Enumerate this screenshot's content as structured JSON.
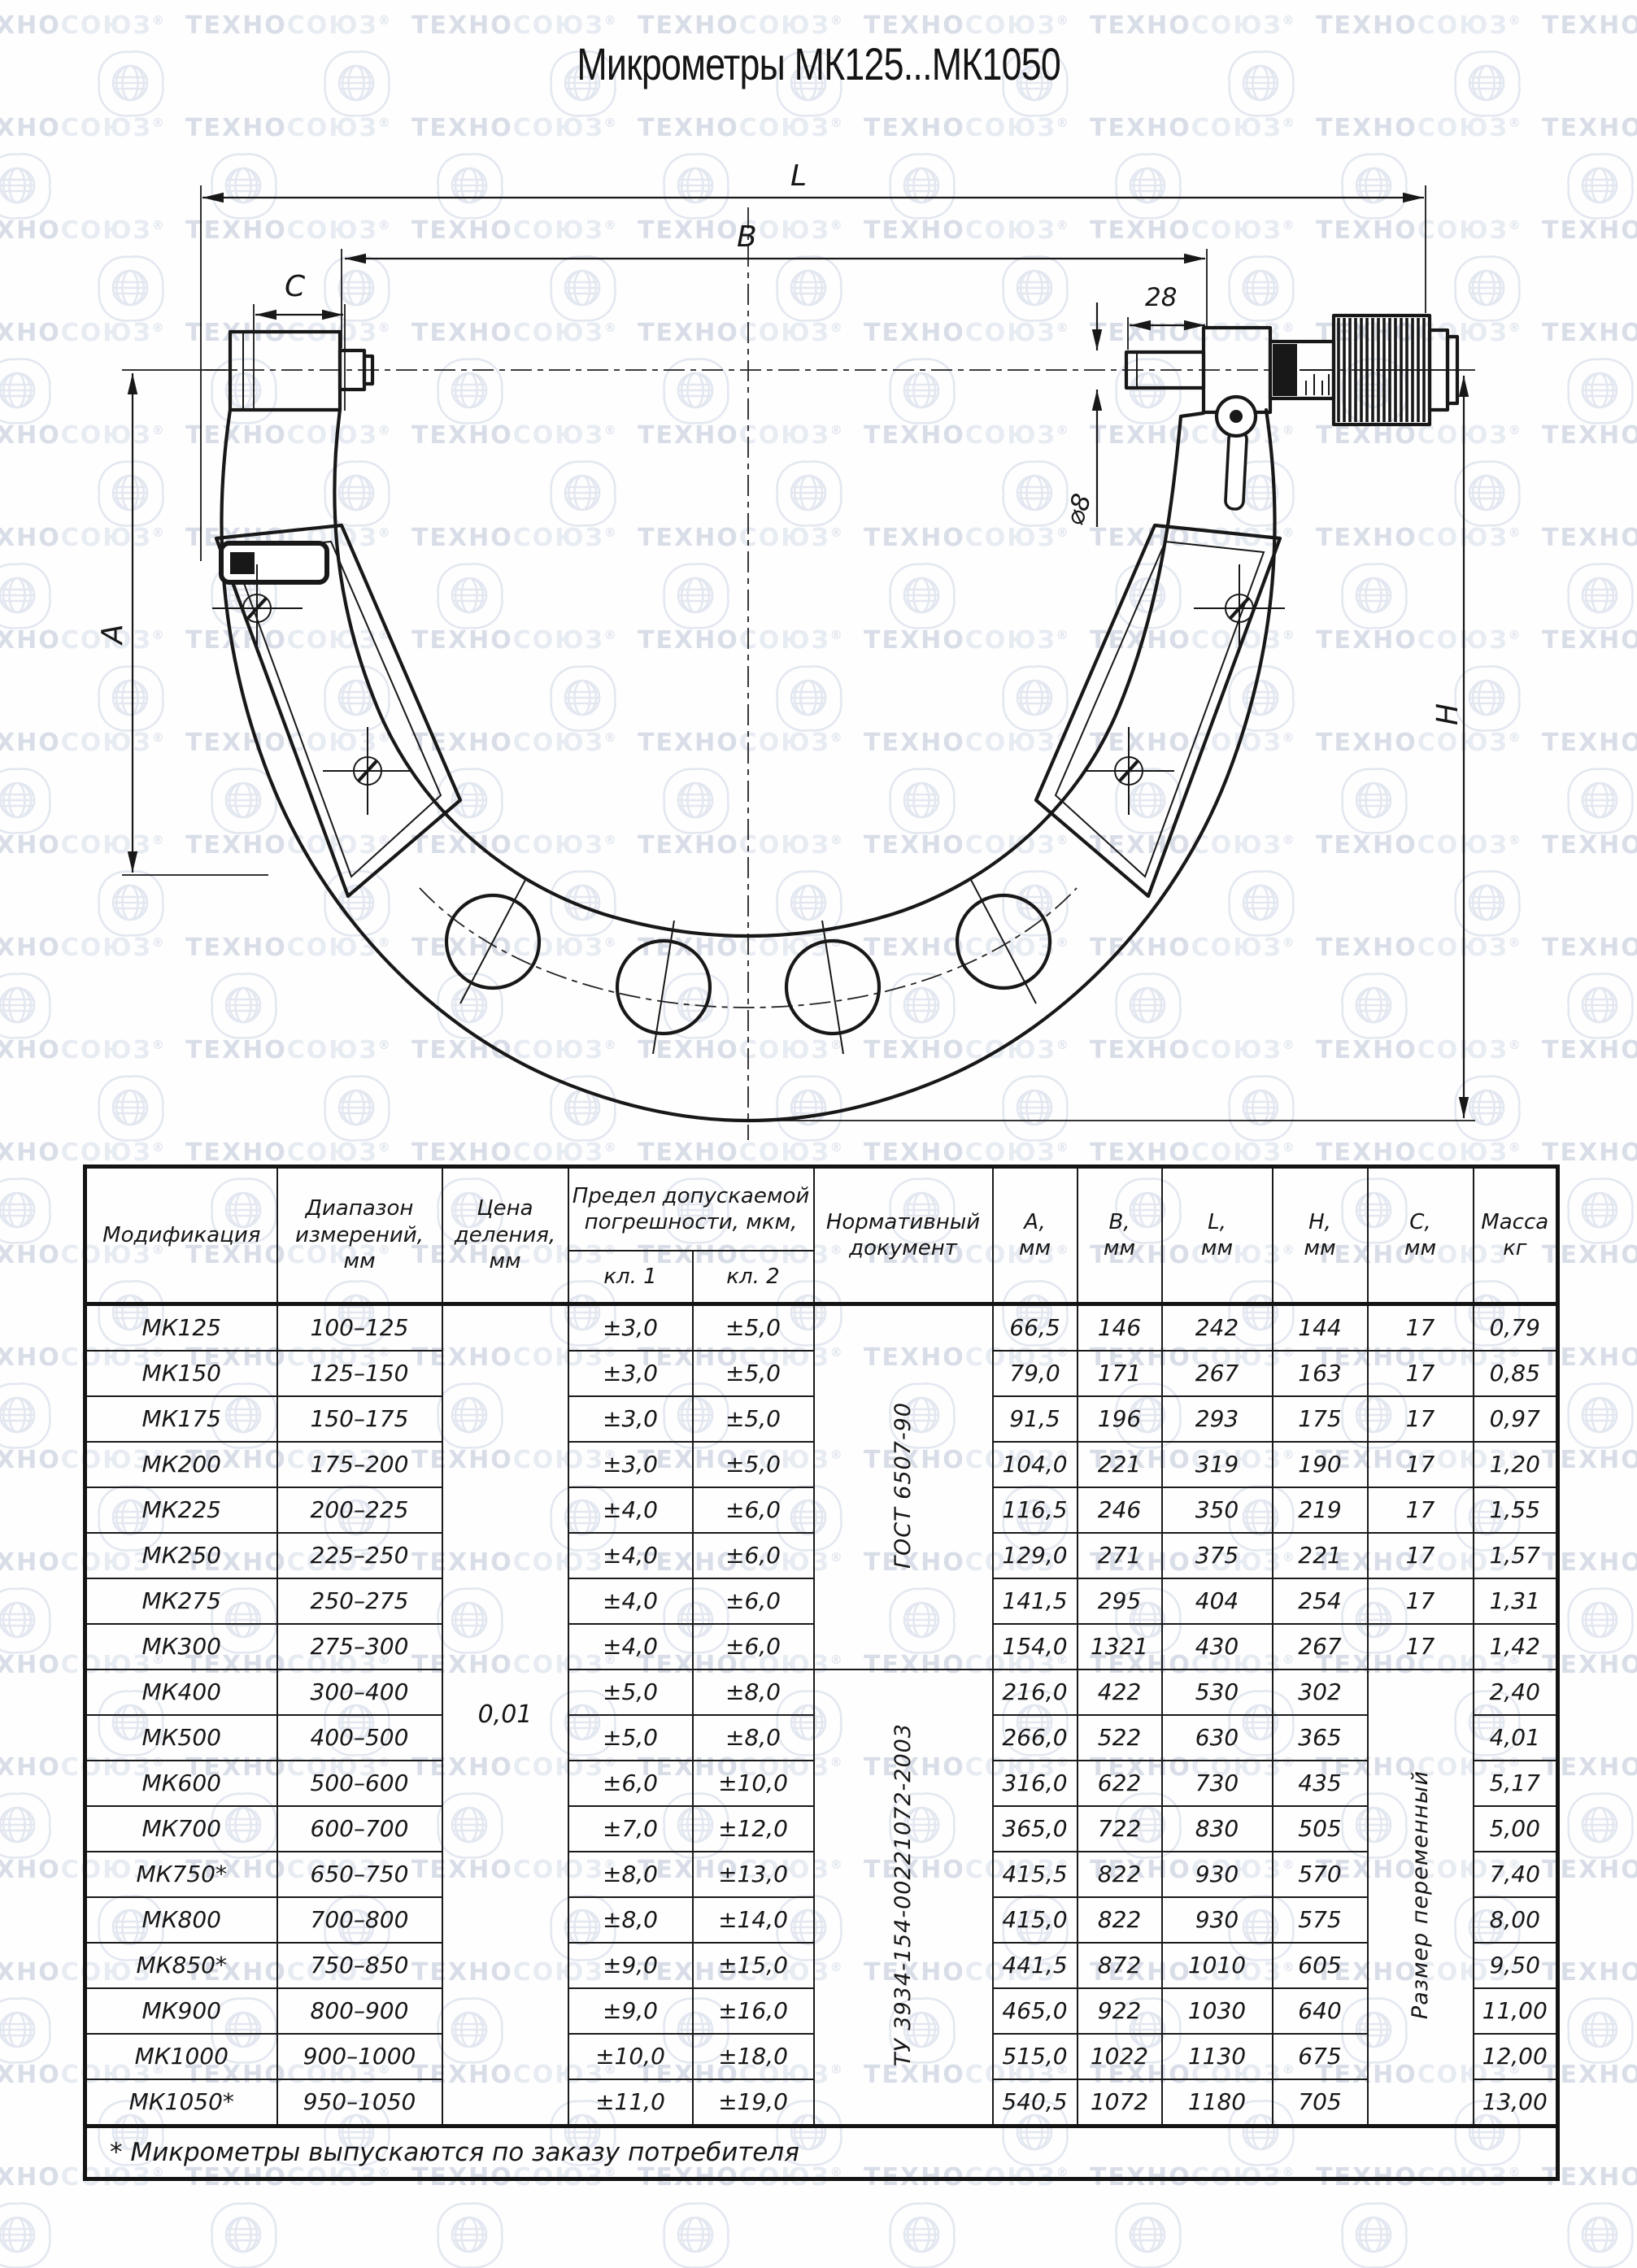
{
  "watermark": {
    "text1": "ТЕХНО",
    "text2": "СОЮЗ",
    "reg": "®"
  },
  "title": "Микрометры МК125...МК1050",
  "drawing": {
    "labels": {
      "L": "L",
      "B": "B",
      "C": "C",
      "d28": "28",
      "dia8": "⌀8",
      "A": "A",
      "H": "H"
    }
  },
  "table": {
    "headers": {
      "modification": "Модификация",
      "range": "Диапазон\nизмерений,\nмм",
      "division": "Цена\nделения,\nмм",
      "error": "Предел допускаемой\nпогрешности, мкм,",
      "class1": "кл. 1",
      "class2": "кл. 2",
      "document": "Нормативный\nдокумент",
      "colA": "A,\nмм",
      "colB": "B,\nмм",
      "colL": "L,\nмм",
      "colH": "H,\nмм",
      "colC": "C,\nмм",
      "mass": "Масса\nкг"
    },
    "division_value": "0,01",
    "doc_groups": [
      {
        "label": "ГОСТ 6507-90",
        "rows": 8
      },
      {
        "label": "ТУ 3934-154-00221072-2003",
        "rows": 10
      }
    ],
    "c_fixed_rows": 8,
    "c_variable_label": "Размер переменный",
    "rows": [
      {
        "model": "МК125",
        "range": "100–125",
        "cl1": "±3,0",
        "cl2": "±5,0",
        "a": "66,5",
        "b": "146",
        "l": "242",
        "h": "144",
        "c": "17",
        "mass": "0,79"
      },
      {
        "model": "МК150",
        "range": "125–150",
        "cl1": "±3,0",
        "cl2": "±5,0",
        "a": "79,0",
        "b": "171",
        "l": "267",
        "h": "163",
        "c": "17",
        "mass": "0,85"
      },
      {
        "model": "МК175",
        "range": "150–175",
        "cl1": "±3,0",
        "cl2": "±5,0",
        "a": "91,5",
        "b": "196",
        "l": "293",
        "h": "175",
        "c": "17",
        "mass": "0,97"
      },
      {
        "model": "МК200",
        "range": "175–200",
        "cl1": "±3,0",
        "cl2": "±5,0",
        "a": "104,0",
        "b": "221",
        "l": "319",
        "h": "190",
        "c": "17",
        "mass": "1,20"
      },
      {
        "model": "МК225",
        "range": "200–225",
        "cl1": "±4,0",
        "cl2": "±6,0",
        "a": "116,5",
        "b": "246",
        "l": "350",
        "h": "219",
        "c": "17",
        "mass": "1,55"
      },
      {
        "model": "МК250",
        "range": "225–250",
        "cl1": "±4,0",
        "cl2": "±6,0",
        "a": "129,0",
        "b": "271",
        "l": "375",
        "h": "221",
        "c": "17",
        "mass": "1,57"
      },
      {
        "model": "МК275",
        "range": "250–275",
        "cl1": "±4,0",
        "cl2": "±6,0",
        "a": "141,5",
        "b": "295",
        "l": "404",
        "h": "254",
        "c": "17",
        "mass": "1,31"
      },
      {
        "model": "МК300",
        "range": "275–300",
        "cl1": "±4,0",
        "cl2": "±6,0",
        "a": "154,0",
        "b": "1321",
        "l": "430",
        "h": "267",
        "c": "17",
        "mass": "1,42"
      },
      {
        "model": "МК400",
        "range": "300–400",
        "cl1": "±5,0",
        "cl2": "±8,0",
        "a": "216,0",
        "b": "422",
        "l": "530",
        "h": "302",
        "c": "",
        "mass": "2,40"
      },
      {
        "model": "МК500",
        "range": "400–500",
        "cl1": "±5,0",
        "cl2": "±8,0",
        "a": "266,0",
        "b": "522",
        "l": "630",
        "h": "365",
        "c": "",
        "mass": "4,01"
      },
      {
        "model": "МК600",
        "range": "500–600",
        "cl1": "±6,0",
        "cl2": "±10,0",
        "a": "316,0",
        "b": "622",
        "l": "730",
        "h": "435",
        "c": "",
        "mass": "5,17"
      },
      {
        "model": "МК700",
        "range": "600–700",
        "cl1": "±7,0",
        "cl2": "±12,0",
        "a": "365,0",
        "b": "722",
        "l": "830",
        "h": "505",
        "c": "",
        "mass": "5,00"
      },
      {
        "model": "МК750*",
        "range": "650–750",
        "cl1": "±8,0",
        "cl2": "±13,0",
        "a": "415,5",
        "b": "822",
        "l": "930",
        "h": "570",
        "c": "",
        "mass": "7,40"
      },
      {
        "model": "МК800",
        "range": "700–800",
        "cl1": "±8,0",
        "cl2": "±14,0",
        "a": "415,0",
        "b": "822",
        "l": "930",
        "h": "575",
        "c": "",
        "mass": "8,00"
      },
      {
        "model": "МК850*",
        "range": "750–850",
        "cl1": "±9,0",
        "cl2": "±15,0",
        "a": "441,5",
        "b": "872",
        "l": "1010",
        "h": "605",
        "c": "",
        "mass": "9,50"
      },
      {
        "model": "МК900",
        "range": "800–900",
        "cl1": "±9,0",
        "cl2": "±16,0",
        "a": "465,0",
        "b": "922",
        "l": "1030",
        "h": "640",
        "c": "",
        "mass": "11,00"
      },
      {
        "model": "МК1000",
        "range": "900–1000",
        "cl1": "±10,0",
        "cl2": "±18,0",
        "a": "515,0",
        "b": "1022",
        "l": "1130",
        "h": "675",
        "c": "",
        "mass": "12,00"
      },
      {
        "model": "МК1050*",
        "range": "950–1050",
        "cl1": "±11,0",
        "cl2": "±19,0",
        "a": "540,5",
        "b": "1072",
        "l": "1180",
        "h": "705",
        "c": "",
        "mass": "13,00"
      }
    ]
  },
  "footnote": "* Микрометры выпускаются по заказу потребителя"
}
